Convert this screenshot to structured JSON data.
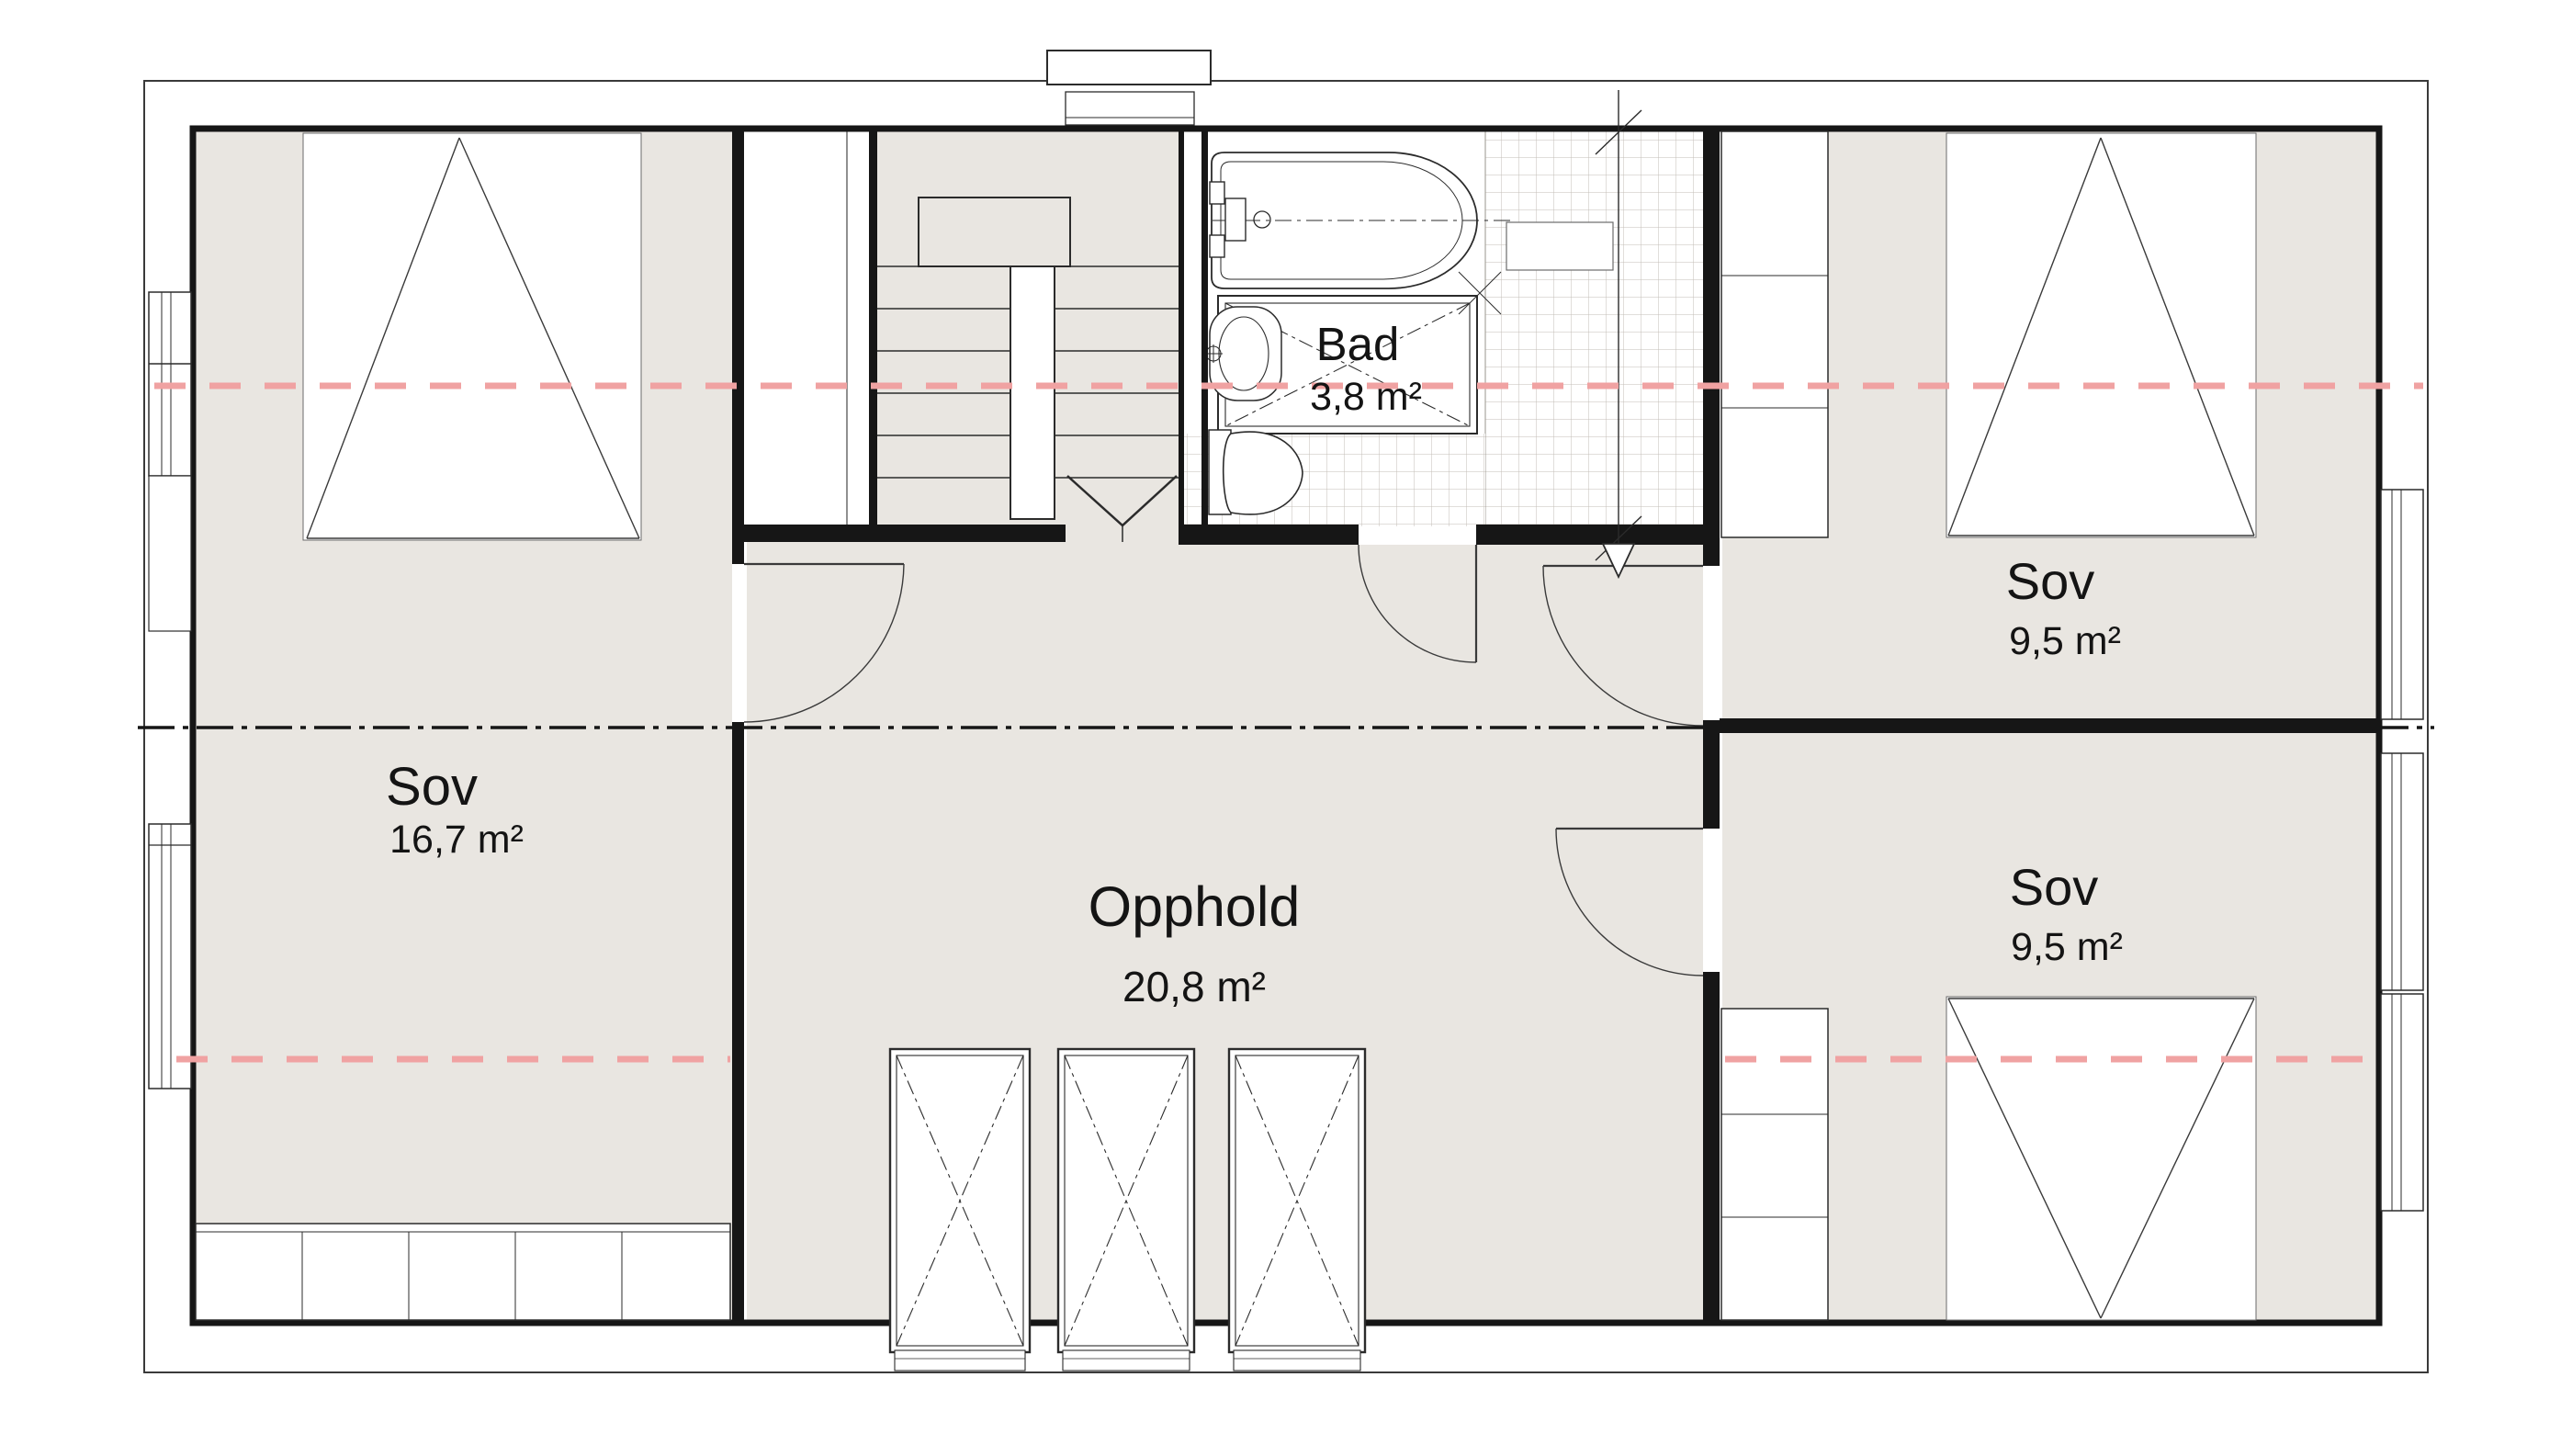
{
  "colors": {
    "floor": "#e9e6e1",
    "wall": "#161616",
    "thin_line": "#3a3a3a",
    "accent_red": "#f0a2a2",
    "tile_line": "#c3beb7"
  },
  "rooms": {
    "sov_left": {
      "name": "Sov",
      "area": "16,7 m²"
    },
    "opphold": {
      "name": "Opphold",
      "area": "20,8 m²"
    },
    "bad": {
      "name": "Bad",
      "area": "3,8 m²"
    },
    "sov_top_right": {
      "name": "Sov",
      "area": "9,5 m²"
    },
    "sov_bottom_right": {
      "name": "Sov",
      "area": "9,5 m²"
    }
  }
}
